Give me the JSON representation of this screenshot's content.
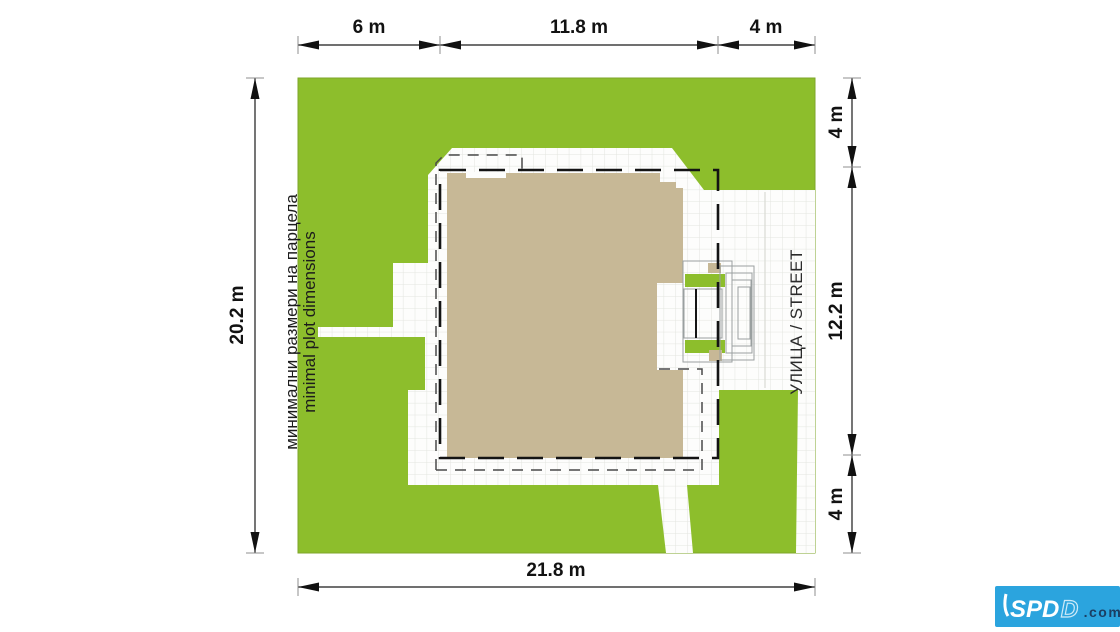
{
  "colors": {
    "plot_green": "#8DBE2C",
    "plot_green_edge": "#7EA62A",
    "house_beige": "#C7B896",
    "paved_white": "#FDFDFC",
    "grid_line": "#E3E5DF",
    "logo_blue": "#2BA4DE",
    "logo_navy": "#1B3E63"
  },
  "dimensions": {
    "top": [
      {
        "label": "6 m"
      },
      {
        "label": "11.8 m"
      },
      {
        "label": "4 m"
      }
    ],
    "right": [
      {
        "label": "4 m"
      },
      {
        "label": "12.2 m"
      },
      {
        "label": "4 m"
      }
    ],
    "left": {
      "label": "20.2 m"
    },
    "bottom": {
      "label": "21.8 m"
    }
  },
  "annotations": {
    "plot_label_bg": "минимални размери на парцела",
    "plot_label_en": "minimal plot dimensions",
    "street_label": "УЛИЦА / STREET"
  },
  "logo": {
    "brand": "SPD",
    "brand_outline": "D",
    "suffix": ".com"
  }
}
